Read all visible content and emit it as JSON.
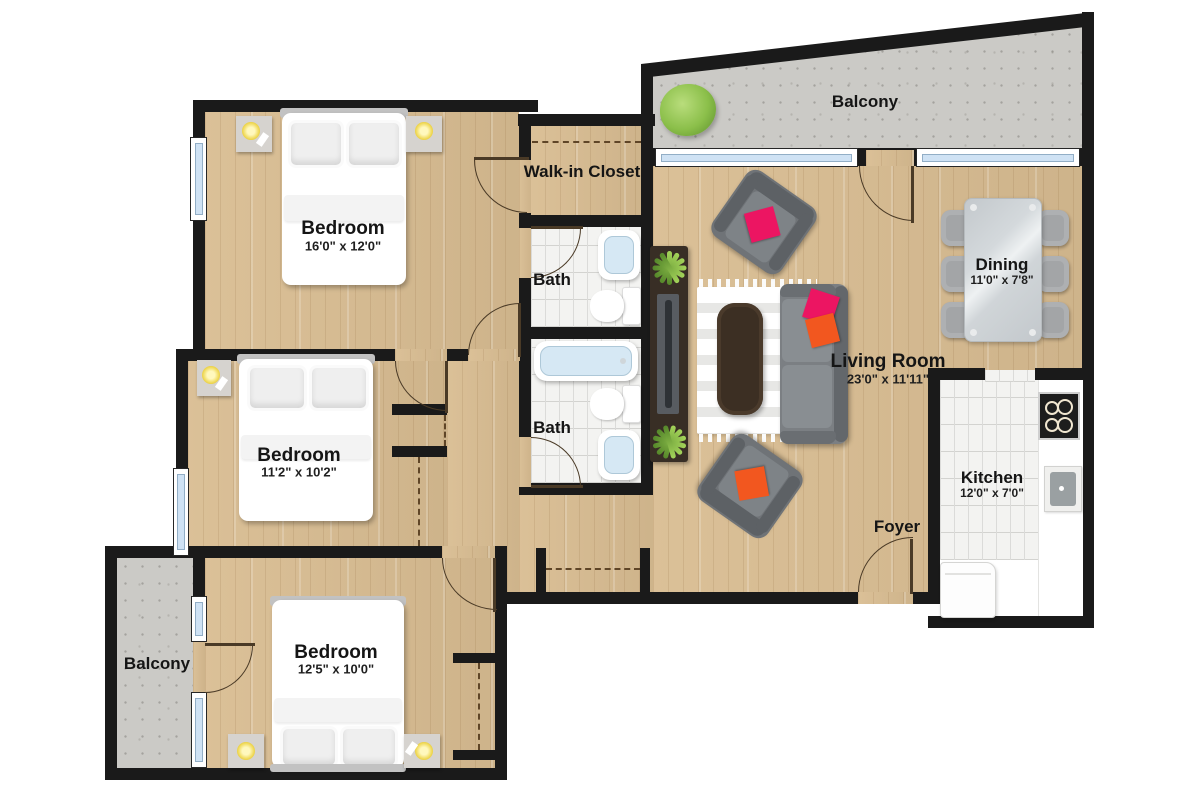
{
  "rooms": {
    "bedroom_top": {
      "label": "Bedroom",
      "dimensions": "16'0\" x 12'0\""
    },
    "bedroom_middle": {
      "label": "Bedroom",
      "dimensions": "11'2\" x 10'2\""
    },
    "bedroom_bottom": {
      "label": "Bedroom",
      "dimensions": "12'5\" x 10'0\""
    },
    "living_room": {
      "label": "Living Room",
      "dimensions": "23'0\" x 11'11\""
    },
    "dining": {
      "label": "Dining",
      "dimensions": "11'0\" x 7'8\""
    },
    "kitchen": {
      "label": "Kitchen",
      "dimensions": "12'0\" x 7'0\""
    },
    "walk_in_closet": {
      "label": "Walk-in Closet"
    },
    "bath_upper": {
      "label": "Bath"
    },
    "bath_lower": {
      "label": "Bath"
    },
    "foyer": {
      "label": "Foyer"
    },
    "balcony_top": {
      "label": "Balcony"
    },
    "balcony_bottom": {
      "label": "Balcony"
    }
  },
  "colors": {
    "wall": "#1a1a1a",
    "wood_floor": "#d9bd92",
    "balcony_concrete": "#cbcac6",
    "window_glass": "#cfe2f4",
    "accent_pink": "#ec1562",
    "accent_orange": "#f2571f",
    "plant_green": "#8cc043",
    "tub_blue": "#d6e8f4"
  }
}
